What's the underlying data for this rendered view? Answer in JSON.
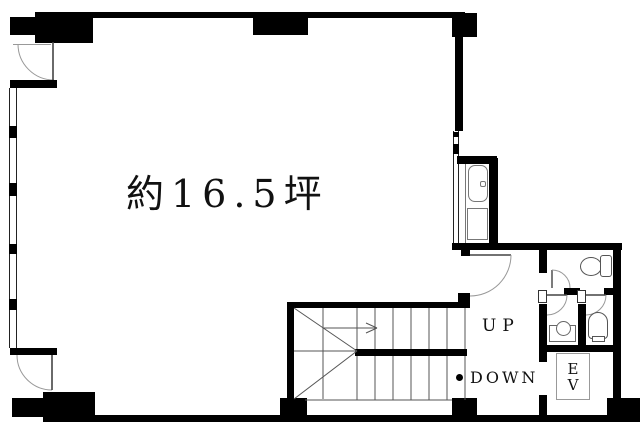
{
  "floor_plan": {
    "labels": {
      "area": "約16.5坪",
      "up": "UP",
      "down": "DOWN",
      "ev_line1": "E",
      "ev_line2": "V"
    },
    "colors": {
      "wall": "#000000",
      "fixture_line": "#777777",
      "door_arc": "#999999",
      "stair_line": "#555555",
      "background": "#ffffff",
      "text": "#111111"
    },
    "rooms": {
      "main_room_note": "約16.5坪",
      "stairwell_direction_up": "UP",
      "stairwell_direction_down": "DOWN",
      "elevator": "EV"
    }
  }
}
